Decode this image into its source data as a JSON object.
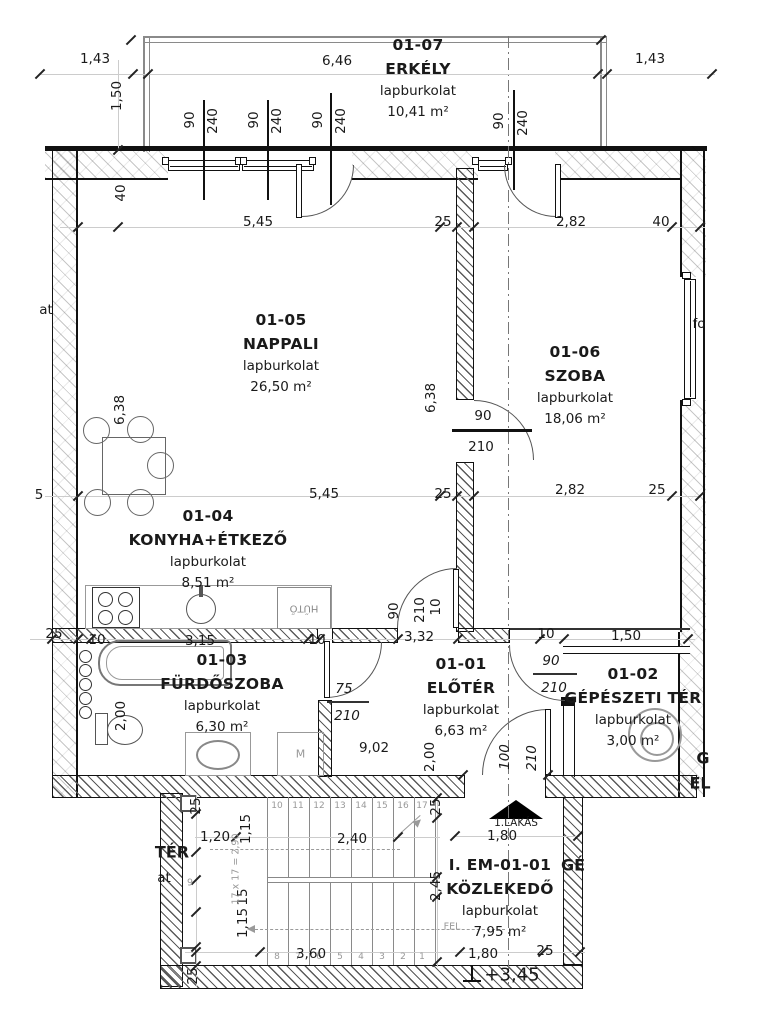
{
  "drawing": {
    "rooms": [
      {
        "id": "erkely",
        "code": "01-07",
        "name": "ERKÉLY",
        "finish": "lapburkolat",
        "area": "10,41 m²"
      },
      {
        "id": "nappali",
        "code": "01-05",
        "name": "NAPPALI",
        "finish": "lapburkolat",
        "area": "26,50 m²"
      },
      {
        "id": "szoba",
        "code": "01-06",
        "name": "SZOBA",
        "finish": "lapburkolat",
        "area": "18,06 m²"
      },
      {
        "id": "konyha-etkezo",
        "code": "01-04",
        "name": "KONYHA+ÉTKEZŐ",
        "finish": "lapburkolat",
        "area": "8,51 m²"
      },
      {
        "id": "furdoszoba",
        "code": "01-03",
        "name": "FÜRDŐSZOBA",
        "finish": "lapburkolat",
        "area": "6,30 m²"
      },
      {
        "id": "eloter",
        "code": "01-01",
        "name": "ELŐTÉR",
        "finish": "lapburkolat",
        "area": "6,63 m²"
      },
      {
        "id": "gepeszeti-ter",
        "code": "01-02",
        "name": "GÉPÉSZETI TÉR",
        "finish": "lapburkolat",
        "area": "3,00 m²"
      },
      {
        "id": "kozlekedo",
        "code": "I. EM-01-01",
        "name": "KÖZLEKEDŐ",
        "finish": "lapburkolat",
        "area": "7,95 m²"
      }
    ],
    "fixtures": {
      "fridge": "HŰTŐ",
      "washer": "M",
      "apartment_marker": "1.LAKÁS",
      "level_mark": "+3,45",
      "up_label": "FEL"
    },
    "stair": {
      "formula": "17 x 17 = 2,90",
      "landing_number": "9",
      "top_numbers": [
        "10",
        "11",
        "12",
        "13",
        "14",
        "15",
        "16",
        "17"
      ],
      "bottom_numbers": [
        "8",
        "7",
        "6",
        "5",
        "4",
        "3",
        "2",
        "1"
      ],
      "x_positions": [
        277,
        298,
        319,
        340,
        361,
        382,
        403,
        422
      ],
      "top_y": 806,
      "bottom_y": 957
    },
    "dims": [
      {
        "t": "1,43",
        "x": 95,
        "y": 59
      },
      {
        "t": "6,46",
        "x": 337,
        "y": 61
      },
      {
        "t": "1,43",
        "x": 650,
        "y": 59
      },
      {
        "t": "1,50",
        "x": 117,
        "y": 96,
        "r": 1
      },
      {
        "t": "90",
        "x": 190,
        "y": 120,
        "r": 1
      },
      {
        "t": "240",
        "x": 213,
        "y": 121,
        "r": 1
      },
      {
        "t": "90",
        "x": 254,
        "y": 120,
        "r": 1
      },
      {
        "t": "240",
        "x": 277,
        "y": 121,
        "r": 1
      },
      {
        "t": "90",
        "x": 318,
        "y": 120,
        "r": 1
      },
      {
        "t": "240",
        "x": 341,
        "y": 121,
        "r": 1
      },
      {
        "t": "90",
        "x": 499,
        "y": 121,
        "r": 1
      },
      {
        "t": "240",
        "x": 523,
        "y": 123,
        "r": 1
      },
      {
        "t": "40",
        "x": 121,
        "y": 193,
        "r": 1
      },
      {
        "t": "5,45",
        "x": 258,
        "y": 222
      },
      {
        "t": "25",
        "x": 443,
        "y": 222
      },
      {
        "t": "2,82",
        "x": 571,
        "y": 222
      },
      {
        "t": "40",
        "x": 661,
        "y": 222
      },
      {
        "t": "6,38",
        "x": 120,
        "y": 410,
        "r": 1
      },
      {
        "t": "6,38",
        "x": 431,
        "y": 398,
        "r": 1
      },
      {
        "t": "90",
        "x": 483,
        "y": 416
      },
      {
        "t": "210",
        "x": 481,
        "y": 447
      },
      {
        "t": "5,45",
        "x": 324,
        "y": 494
      },
      {
        "t": "25",
        "x": 443,
        "y": 494
      },
      {
        "t": "2,82",
        "x": 570,
        "y": 490
      },
      {
        "t": "25",
        "x": 657,
        "y": 490
      },
      {
        "t": "25",
        "x": 54,
        "y": 634
      },
      {
        "t": "10",
        "x": 97,
        "y": 640
      },
      {
        "t": "3,15",
        "x": 200,
        "y": 641
      },
      {
        "t": "10",
        "x": 317,
        "y": 640
      },
      {
        "t": "90",
        "x": 394,
        "y": 611,
        "r": 1
      },
      {
        "t": "210",
        "x": 420,
        "y": 610,
        "r": 1
      },
      {
        "t": "10",
        "x": 436,
        "y": 607,
        "r": 1
      },
      {
        "t": "3,32",
        "x": 419,
        "y": 637
      },
      {
        "t": "10",
        "x": 546,
        "y": 634
      },
      {
        "t": "90",
        "x": 551,
        "y": 661,
        "i": 1
      },
      {
        "t": "210",
        "x": 554,
        "y": 688,
        "i": 1
      },
      {
        "t": "1,50",
        "x": 626,
        "y": 636
      },
      {
        "t": "2,00",
        "x": 121,
        "y": 716,
        "r": 1
      },
      {
        "t": "75",
        "x": 344,
        "y": 689,
        "i": 1
      },
      {
        "t": "210",
        "x": 347,
        "y": 716,
        "i": 1
      },
      {
        "t": "9,02",
        "x": 374,
        "y": 748
      },
      {
        "t": "2,00",
        "x": 430,
        "y": 757,
        "r": 1
      },
      {
        "t": "100",
        "x": 505,
        "y": 757,
        "r": 1,
        "i": 1
      },
      {
        "t": "210",
        "x": 532,
        "y": 758,
        "r": 1,
        "i": 1
      },
      {
        "t": "1.LAKÁS",
        "x": 516,
        "y": 823,
        "s": 10.5
      },
      {
        "t": "1,80",
        "x": 502,
        "y": 836
      },
      {
        "t": "25",
        "x": 196,
        "y": 806,
        "r": 1
      },
      {
        "t": "1,20",
        "x": 215,
        "y": 837
      },
      {
        "t": "1,15",
        "x": 246,
        "y": 829,
        "r": 1
      },
      {
        "t": "2,40",
        "x": 352,
        "y": 839
      },
      {
        "t": "25",
        "x": 436,
        "y": 807,
        "r": 1
      },
      {
        "t": "2,45",
        "x": 436,
        "y": 886,
        "r": 1
      },
      {
        "t": "15",
        "x": 243,
        "y": 897,
        "r": 1
      },
      {
        "t": "1,15",
        "x": 243,
        "y": 923,
        "r": 1
      },
      {
        "t": "3,60",
        "x": 311,
        "y": 954
      },
      {
        "t": "1,80",
        "x": 483,
        "y": 954
      },
      {
        "t": "25",
        "x": 545,
        "y": 951
      },
      {
        "t": "25",
        "x": 193,
        "y": 976,
        "r": 1
      },
      {
        "t": "+3,45",
        "x": 512,
        "y": 975,
        "s": 18
      },
      {
        "t": "17 x 17 = 2,90",
        "x": 236,
        "y": 869,
        "r": 1,
        "g": 1
      },
      {
        "t": "9",
        "x": 190,
        "y": 883,
        "g": 1
      },
      {
        "t": "FEL",
        "x": 452,
        "y": 927,
        "g": 1
      },
      {
        "t": "at",
        "x": 46,
        "y": 310
      },
      {
        "t": "5",
        "x": 39,
        "y": 495
      },
      {
        "t": "fo",
        "x": 699,
        "y": 324
      },
      {
        "t": "TÉR",
        "x": 172,
        "y": 852,
        "b": 1
      },
      {
        "t": "at",
        "x": 164,
        "y": 878
      },
      {
        "t": "GÉ",
        "x": 573,
        "y": 865,
        "b": 1
      },
      {
        "t": "G",
        "x": 703,
        "y": 758,
        "b": 1
      },
      {
        "t": "EL",
        "x": 700,
        "y": 783,
        "b": 1
      }
    ]
  }
}
